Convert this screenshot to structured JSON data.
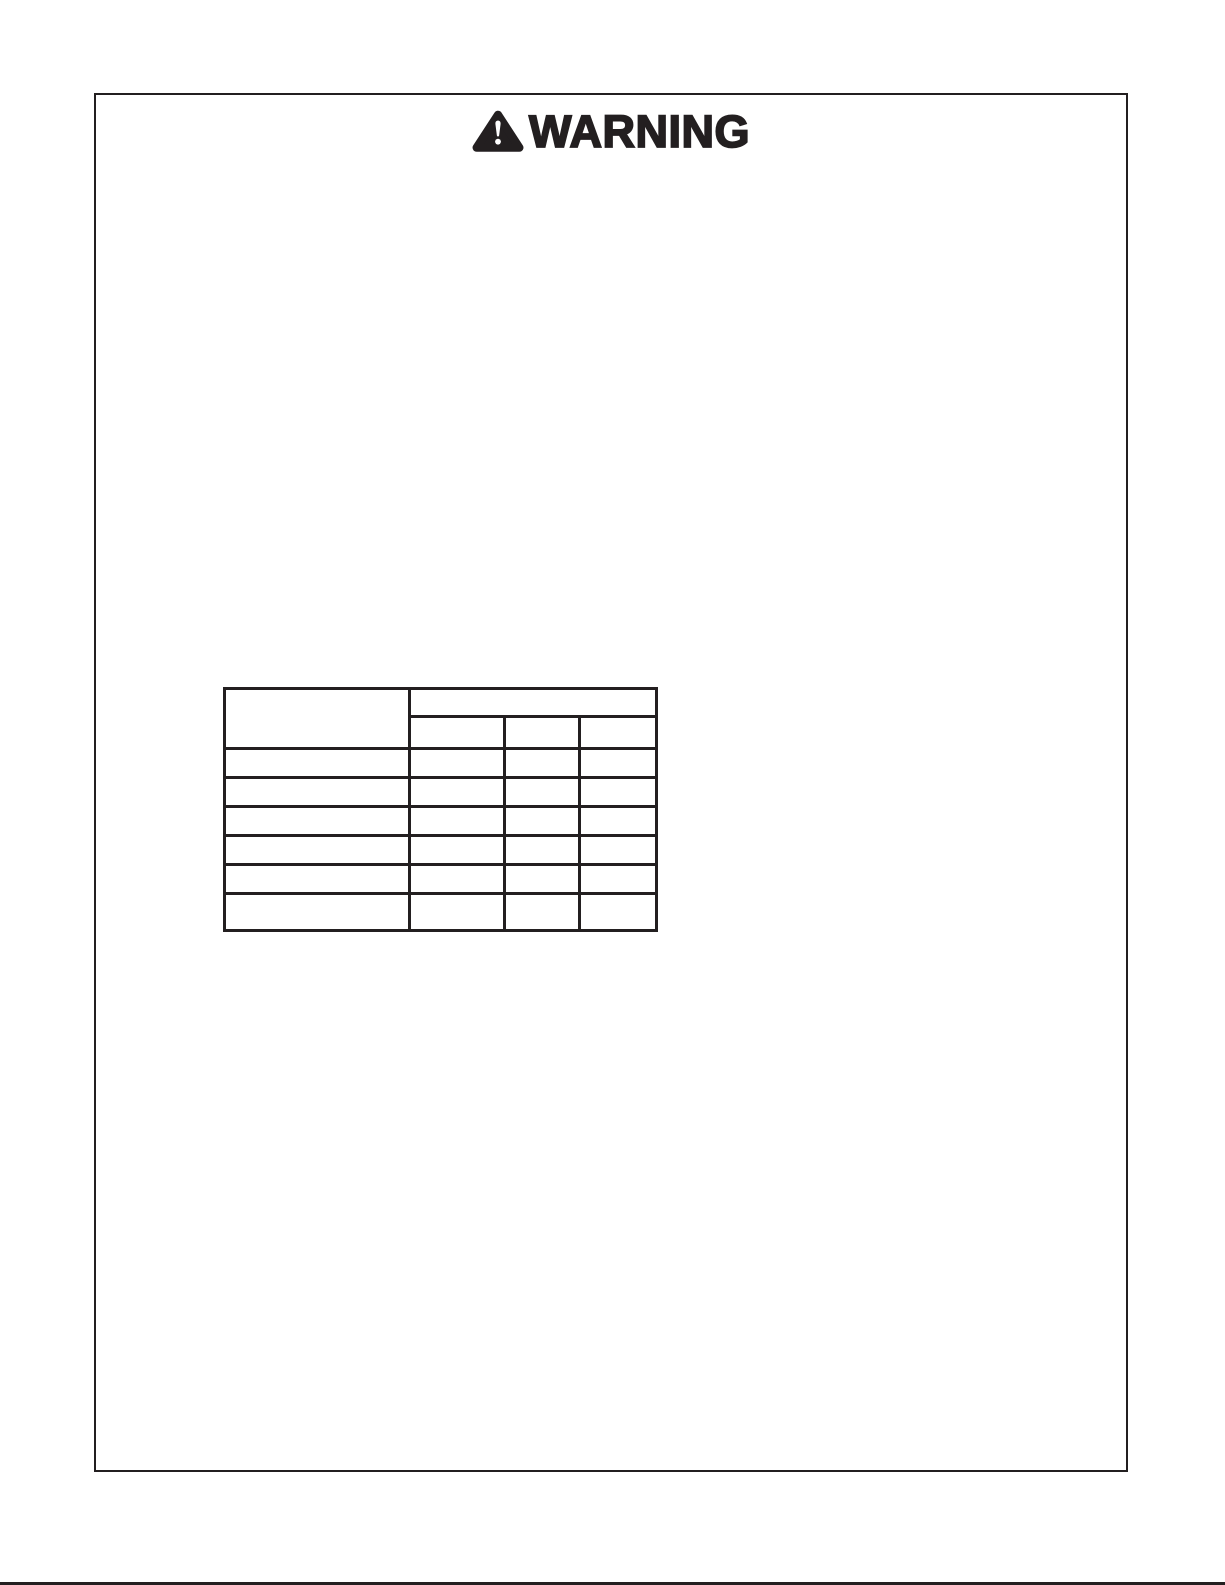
{
  "warning": {
    "label": "WARNING",
    "icon": "warning-triangle"
  },
  "table": {
    "corner_header": "",
    "span_header": "",
    "sub_headers": [
      "",
      "",
      ""
    ],
    "rows": [
      {
        "label": "",
        "values": [
          "",
          "",
          ""
        ]
      },
      {
        "label": "",
        "values": [
          "",
          "",
          ""
        ]
      },
      {
        "label": "",
        "values": [
          "",
          "",
          ""
        ]
      },
      {
        "label": "",
        "values": [
          "",
          "",
          ""
        ]
      },
      {
        "label": "",
        "values": [
          "",
          "",
          ""
        ]
      },
      {
        "label": "",
        "values": [
          "",
          "",
          ""
        ]
      }
    ]
  },
  "colors": {
    "ink": "#231f20",
    "paper": "#ffffff"
  }
}
